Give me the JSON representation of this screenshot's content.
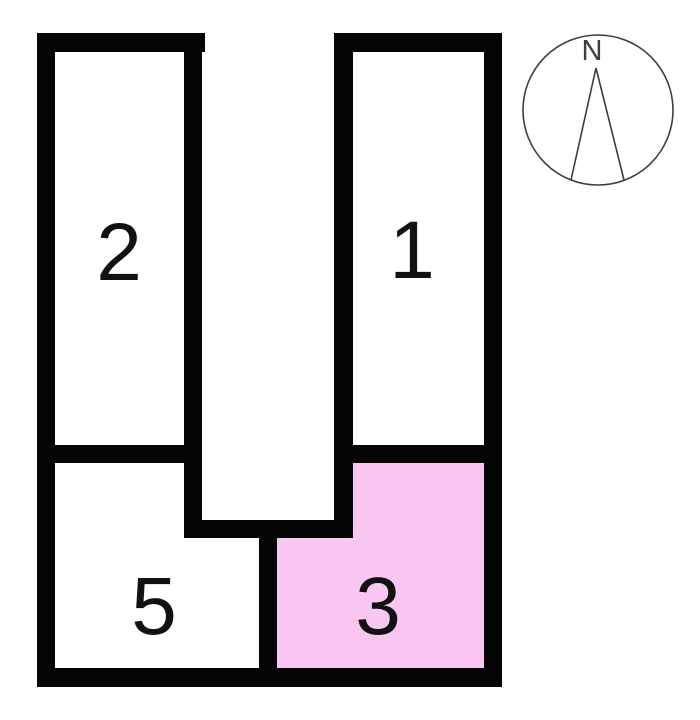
{
  "page": {
    "background": "#ffffff"
  },
  "plan": {
    "wall_color": "#050505",
    "label_color": "#111111",
    "rooms": [
      {
        "key": "room-2",
        "label": "2",
        "fill": "#ffffff",
        "highlighted": false
      },
      {
        "key": "room-1",
        "label": "1",
        "fill": "#ffffff",
        "highlighted": false
      },
      {
        "key": "room-5",
        "label": "5",
        "fill": "#ffffff",
        "highlighted": false
      },
      {
        "key": "room-3",
        "label": "3",
        "fill": "#f9c6f2",
        "highlighted": true
      }
    ]
  },
  "compass": {
    "north_label": "N",
    "stroke": "#3d3d3d"
  }
}
